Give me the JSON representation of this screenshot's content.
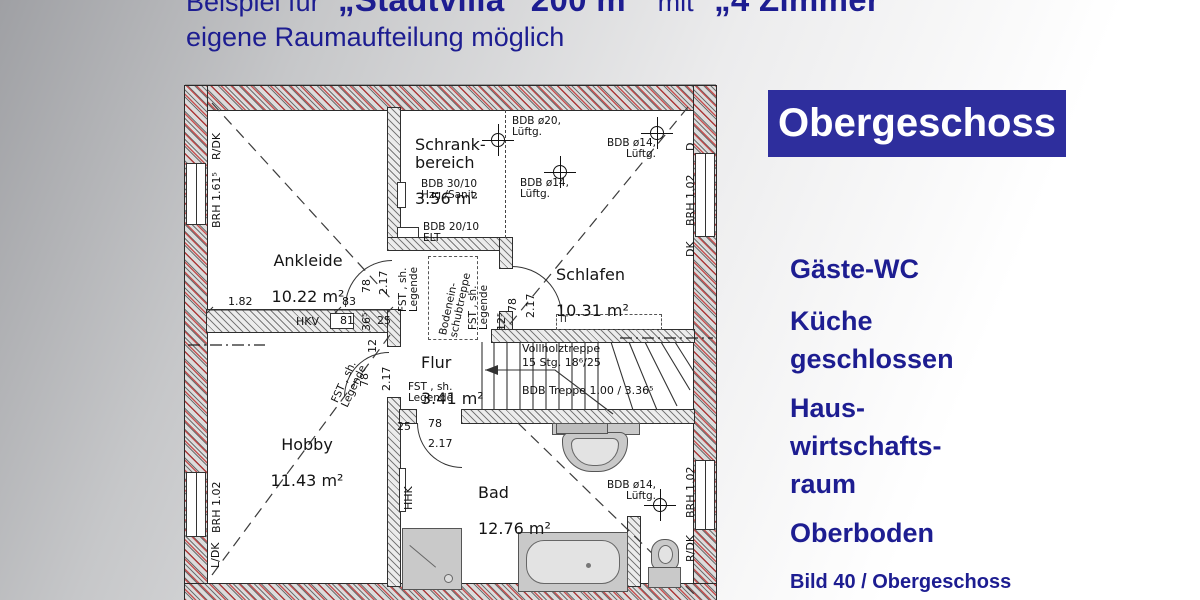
{
  "title": {
    "prefix": "Beispiel für",
    "highlight1": "„Stadtvilla“ 200 m²",
    "mid": "mit",
    "highlight2": "„4 Zimmer“",
    "subtitle": "eigene Raumaufteilung möglich"
  },
  "panel": {
    "heading": "Obergeschoss",
    "features": [
      "Gäste-WC",
      "Küche\ngeschlossen",
      "Haus-\nwirtschafts-\nraum",
      "Oberboden"
    ],
    "caption": "Bild  40 / Obergeschoss"
  },
  "colors": {
    "navy_text": "#1d1d91",
    "heading_box": "#2e2e9d",
    "wall_red": "#be2828"
  },
  "plan": {
    "rooms": [
      {
        "name": "Schrank-\nbereich",
        "area": "3.56 m²"
      },
      {
        "name": "Ankleide",
        "area": "10.22 m²"
      },
      {
        "name": "Schlafen",
        "area": "10.31 m²"
      },
      {
        "name": "Flur",
        "area": "3.41 m²"
      },
      {
        "name": "Hobby",
        "area": "11.43 m²"
      },
      {
        "name": "Bad",
        "area": "12.76 m²"
      }
    ],
    "annotations": {
      "vent20": "BDB ø20,\nLüftg.",
      "vent14": "BDB ø14,\nLüftg.",
      "bdb3010": "BDB 30/10\nHzg./Sanit.",
      "bdb2010": "BDB 20/10\nELT",
      "fst": "FST , sh.\nLegende",
      "attic": "Bodenein-\nschubtreppe",
      "it": "IT",
      "hkv": "HKV",
      "hhk": "HHK"
    },
    "stair": {
      "l1": "Vollholztreppe",
      "l2": "15 Stg. 18⁶/25",
      "l3": "BDB Treppe 1.00 / 3.36⁵"
    },
    "dims": {
      "d182": "1.82",
      "d83": "83",
      "d81": "81",
      "d365": "36⁵",
      "d25": "25",
      "d12": "12",
      "d125": "12⁵",
      "d78": "78",
      "d217": "2.17"
    },
    "walls": {
      "brh161": "BRH 1.61⁵",
      "brh102": "BRH 1.02",
      "rdk": "R/DK",
      "ldk": "L/DK",
      "dk": "DK",
      "d": "D"
    }
  }
}
